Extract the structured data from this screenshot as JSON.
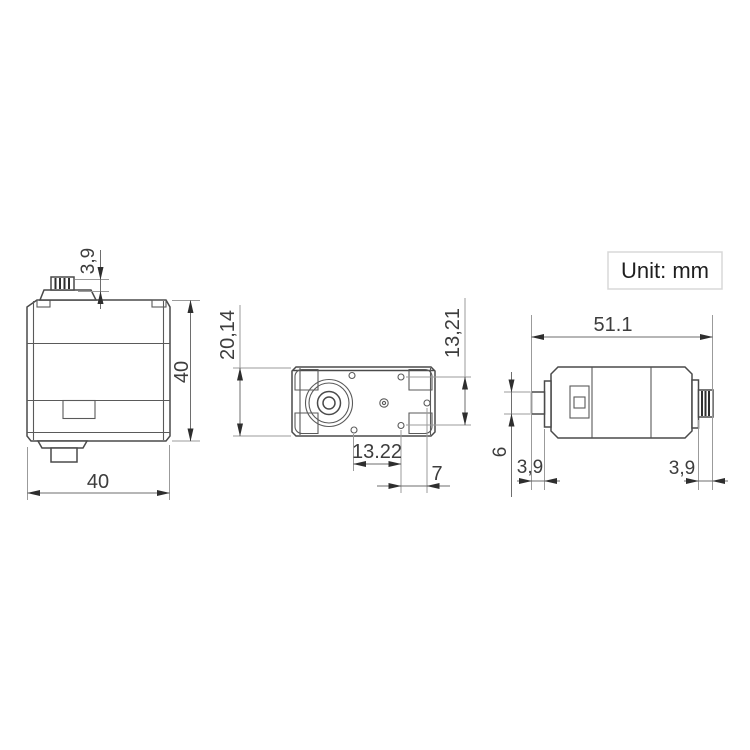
{
  "title": "Servo motor dimensional drawing",
  "unit_box": {
    "label": "Unit: mm"
  },
  "views": {
    "front": {
      "label": "front-view",
      "dims": {
        "spline_height": "3,9",
        "body_height": "40",
        "body_width": "40"
      }
    },
    "top": {
      "label": "top-view",
      "dims": {
        "body_depth": "20,14",
        "hole_span_vertical": "13,21",
        "hole_span_horizontal": "13.22",
        "hole_edge_offset": "7"
      }
    },
    "side": {
      "label": "side-view",
      "dims": {
        "total_length": "51.1",
        "shaft_diameter": "6",
        "front_shaft_length": "3,9",
        "spline_length": "3,9"
      }
    }
  },
  "colors": {
    "object_line": "#4a4a4a",
    "dimension_line": "#9b9b9b",
    "arrow": "#2e2e2e",
    "text": "#3d3d3d",
    "background": "#ffffff",
    "unit_box_border": "#d8d8d8"
  }
}
